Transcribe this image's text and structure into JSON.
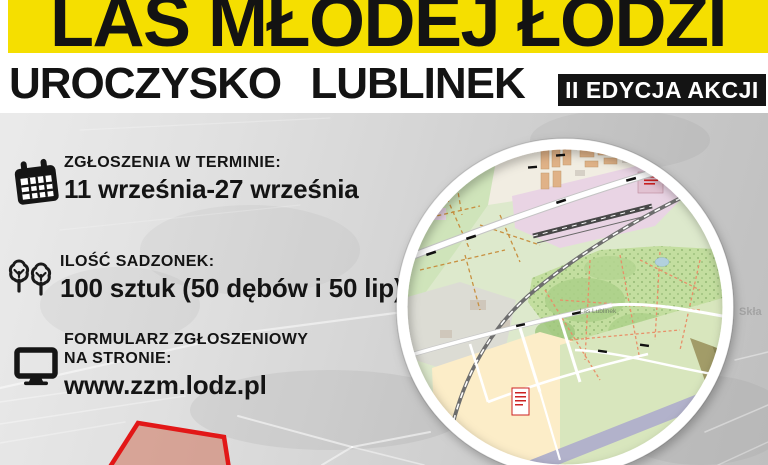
{
  "poster": {
    "title": "LAS MŁODEJ ŁODZI",
    "subtitle": "UROCZYSKO LUBLINEK",
    "badge": "II EDYCJA AKCJI",
    "info": [
      {
        "icon": "calendar-icon",
        "label": "ZGŁOSZENIA W TERMINIE:",
        "value": "11 września-27 września"
      },
      {
        "icon": "trees-icon",
        "label": "ILOŚĆ SADZONEK:",
        "value": "100 sztuk (50 dębów i 50 lip)"
      },
      {
        "icon": "monitor-icon",
        "label": "FORMULARZ ZGŁOSZENIOWY NA STRONIE:",
        "value": "www.zzm.lodz.pl"
      }
    ],
    "map": {
      "forest_label": "Las Lublinek"
    },
    "background_label": "Skła",
    "colors": {
      "banner_yellow": "#F5DF00",
      "badge_black": "#141414",
      "text_black": "#141414",
      "plot_outline_red": "#E21717",
      "plot_fill_salmon": "#CE674E",
      "map_forest_green": "#C3DE9F",
      "map_airport_pink": "#E9D4E4",
      "map_runway_purple": "#B2B2CB",
      "map_field_cream": "#FCEDC8"
    }
  }
}
